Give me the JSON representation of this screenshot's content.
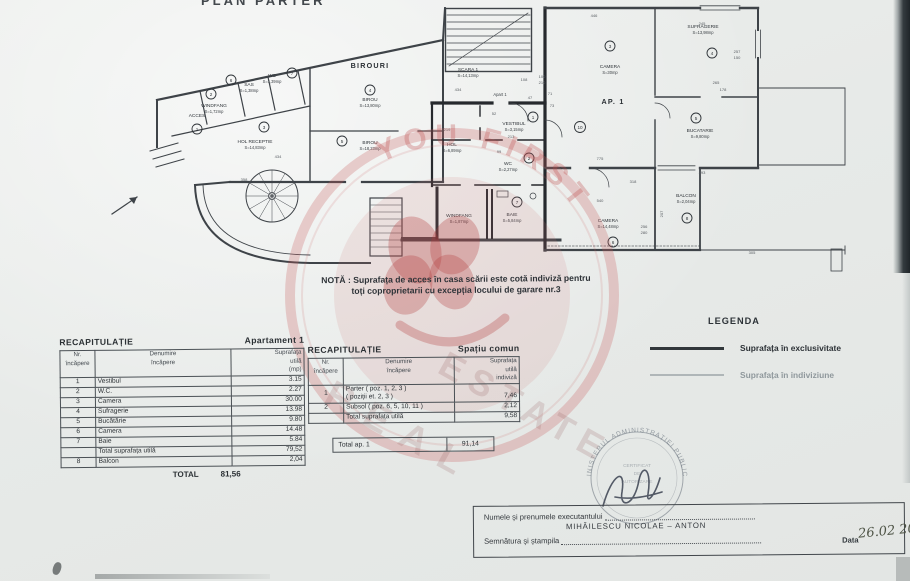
{
  "page": {
    "title": "PLAN PARTER"
  },
  "plan": {
    "rooms": [
      {
        "name": "ACCES",
        "area": "",
        "num": "1"
      },
      {
        "name": "WINDFANG",
        "area": "S=1,72mp",
        "num": "2"
      },
      {
        "name": "SAS",
        "area": "S=1,38mp",
        "num": "6"
      },
      {
        "name": "WC",
        "area": "S=1,39mp",
        "num": "7"
      },
      {
        "name": "HOL RECEPTIE",
        "area": "S=14,83mp",
        "num": "3"
      },
      {
        "name": "BIROU",
        "area": "S=13,80mp",
        "num": "4"
      },
      {
        "name": "BIROU",
        "area": "S=18,23mp",
        "num": "5"
      },
      {
        "name": "SCARA 1",
        "area": "S=14,13mp",
        "num": ""
      },
      {
        "name": "VESTIBUL",
        "area": "S=3,15mp",
        "num": "1"
      },
      {
        "name": "HOL",
        "area": "S=6,89mp",
        "num": ""
      },
      {
        "name": "WC",
        "area": "S=2,27mp",
        "num": "2"
      },
      {
        "name": "WINDFANG",
        "area": "S=1,87mp",
        "num": ""
      },
      {
        "name": "BAIE",
        "area": "S=5,84mp",
        "num": "7"
      },
      {
        "name": "CAMERA",
        "area": "S=30mp",
        "num": "3"
      },
      {
        "name": "SUFRAGERIE",
        "area": "S=13,98mp",
        "num": "4"
      },
      {
        "name": "BUCATARIE",
        "area": "S=9,80mp",
        "num": "5"
      },
      {
        "name": "CAMERA",
        "area": "S=14,48mp",
        "num": "6"
      },
      {
        "name": "BALCON",
        "area": "S=2,04mp",
        "num": "8"
      }
    ],
    "big_labels": {
      "birouri": "BIROURI",
      "ap1": "AP. 1",
      "apart1": "Apart 1",
      "num10": "10"
    },
    "dims": [
      "434",
      "434",
      "446",
      "775",
      "540",
      "318",
      "305",
      "265",
      "178",
      "257",
      "150",
      "219",
      "213",
      "108",
      "100",
      "210",
      "47",
      "71",
      "73",
      "52",
      "99",
      "256",
      "280",
      "207",
      "358",
      "293",
      "245"
    ]
  },
  "note": {
    "line1": "NOTĂ : Suprafața de acces în casa scării este cotă indiviză pentru",
    "line2": "toți coproprietarii cu excepția locului de garare nr.3"
  },
  "recap1": {
    "title": "RECAPITULAȚIE",
    "subtitle": "Apartament 1",
    "col_nr": "Nr.\nîncăpere",
    "col_den": "Denumire\nîncăpere",
    "col_sup": "Suprafața\nutilă\n(mp)",
    "rows": [
      {
        "nr": "1",
        "denumire": "Vestibul",
        "val": "3.15"
      },
      {
        "nr": "2",
        "denumire": "W.C.",
        "val": "2.27"
      },
      {
        "nr": "3",
        "denumire": "Camera",
        "val": "30.00"
      },
      {
        "nr": "4",
        "denumire": "Sufragerie",
        "val": "13.98"
      },
      {
        "nr": "5",
        "denumire": "Bucătărie",
        "val": "9.80"
      },
      {
        "nr": "6",
        "denumire": "Camera",
        "val": "14.48"
      },
      {
        "nr": "7",
        "denumire": "Baie",
        "val": "5.84"
      },
      {
        "nr": "",
        "denumire": "Total suprafața utilă",
        "val": "79,52"
      },
      {
        "nr": "8",
        "denumire": "Balcon",
        "val": "2,04"
      }
    ],
    "total_label": "TOTAL",
    "total_value": "81,56"
  },
  "recap2": {
    "title": "RECAPITULAȚIE",
    "subtitle": "Spațiu comun",
    "col_nr": "Nr.\nîncăpere",
    "col_den": "Denumire\nîncăpere",
    "col_sup": "Suprafața\nutilă\nindiviză",
    "rows": [
      {
        "nr": "1",
        "denumire": "Parter ( poz. 1, 2, 3 )\n( poziții et. 2, 3 )",
        "val": "7,46"
      },
      {
        "nr": "2",
        "denumire": "Subsol ( poz. 6, 5, 10, 11 )",
        "val": "2,12"
      },
      {
        "nr": "",
        "denumire": "Total suprafața utilă",
        "val": "9,58"
      }
    ],
    "grand": {
      "label": "Total ap. 1",
      "value": "91,14"
    }
  },
  "legend": {
    "title": "LEGENDA",
    "items": [
      {
        "label": "Suprafața în exclusivitate"
      },
      {
        "label": "Suprafața în indiviziune"
      }
    ]
  },
  "stamp": {
    "ring_text": "MINISTERUL ADMINISTRAȚIEI PUBLICE",
    "line1": "CERTIFICAT",
    "line2": "DE",
    "line3": "AUTORIZARE"
  },
  "watermark": {
    "arc_text": "YOU FIRST",
    "word1": "REAL",
    "word2": "ESTATE"
  },
  "footer": {
    "label_name": "Numele și prenumele executantului",
    "name": "MIHĂILESCU  NICOLAE – ANTON",
    "label_sign": "Semnătura și ștampila",
    "label_date": "Data",
    "date": "26.02 2006"
  }
}
